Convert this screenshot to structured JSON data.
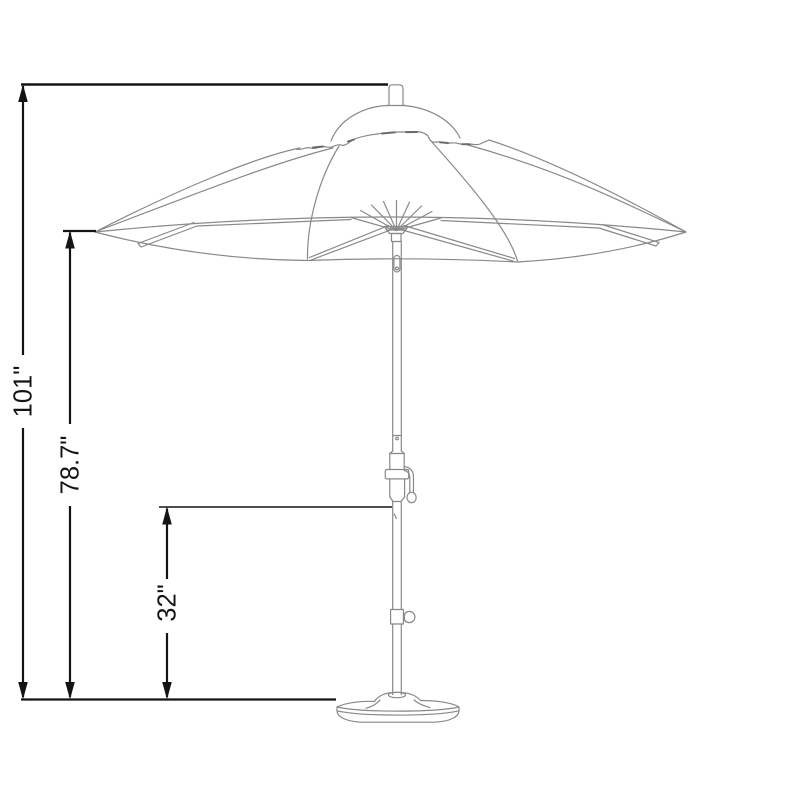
{
  "canvas": {
    "background": "#ffffff"
  },
  "diagram": {
    "subject": "patio umbrella with crank lift, tilt knob and round weighted base",
    "line_colors": {
      "dimension_lines": "#141414",
      "drawing_lines": "#898989"
    },
    "dimensions": [
      {
        "name": "overall-height",
        "label": "101\""
      },
      {
        "name": "canopy-edge-height",
        "label": "78.7\""
      },
      {
        "name": "under-pole-clearance",
        "label": "32\""
      }
    ]
  }
}
